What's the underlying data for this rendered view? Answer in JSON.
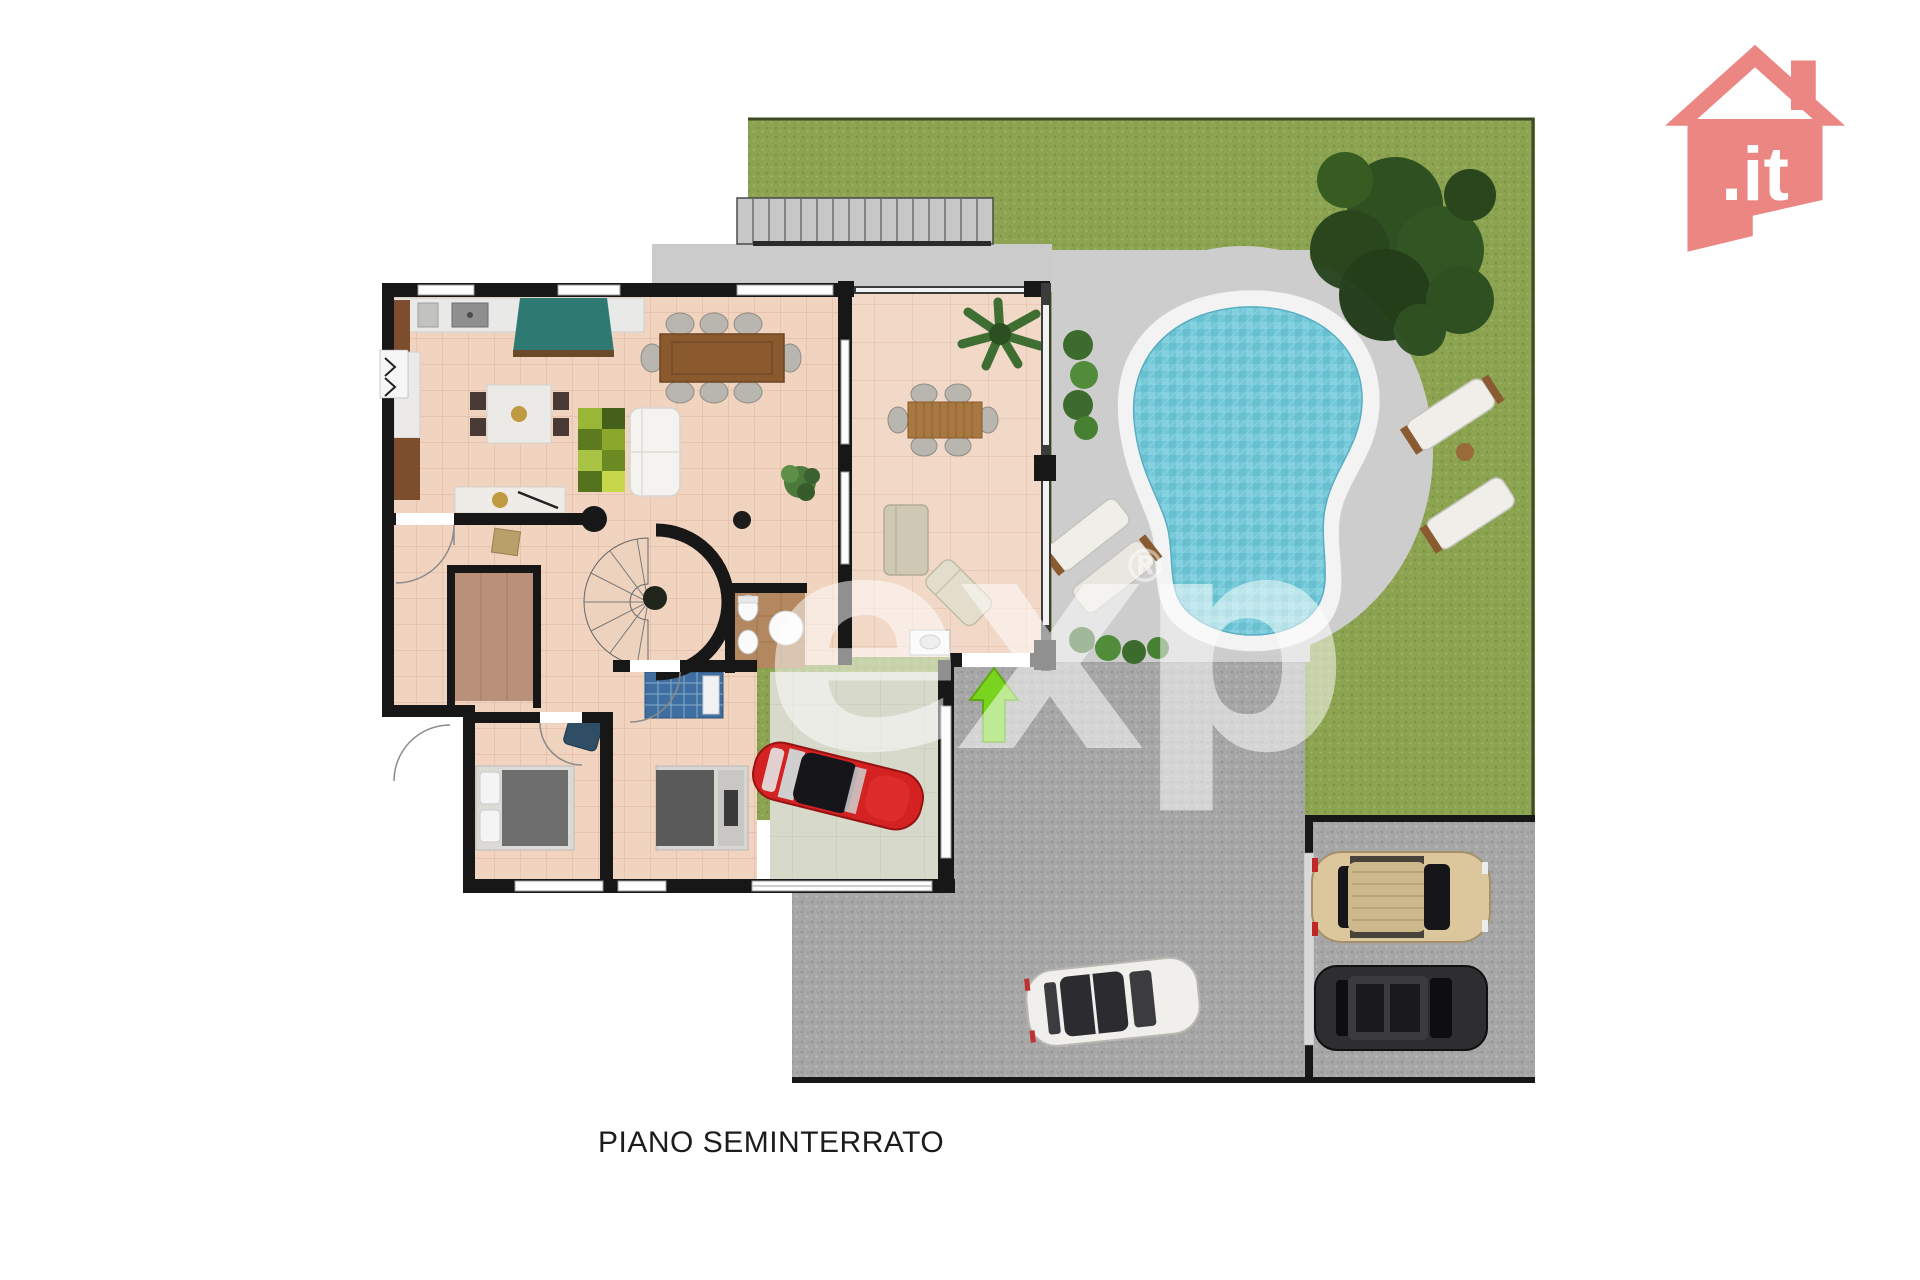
{
  "caption": "PIANO SEMINTERRATO",
  "watermark": {
    "text": "exp",
    "registered": "®"
  },
  "logo": {
    "text": ".it"
  },
  "colors": {
    "logo_salmon": "#ec8682",
    "grass": "#8ca452",
    "pool_deck": "#cdcdcd",
    "driveway_asphalt": "#a7a7a7",
    "pool_water": "#74c7d7",
    "pool_rim": "#f3f3f3",
    "floor_tile": "#f0d4c0",
    "wall_black": "#171717",
    "entrance_arrow_green": "#79d31f",
    "garage_floor": "#d7d9cb",
    "red_car": "#d42222",
    "white_car": "#f0efeb",
    "beige_suv": "#dcc79d",
    "black_suv": "#2e2e30"
  }
}
